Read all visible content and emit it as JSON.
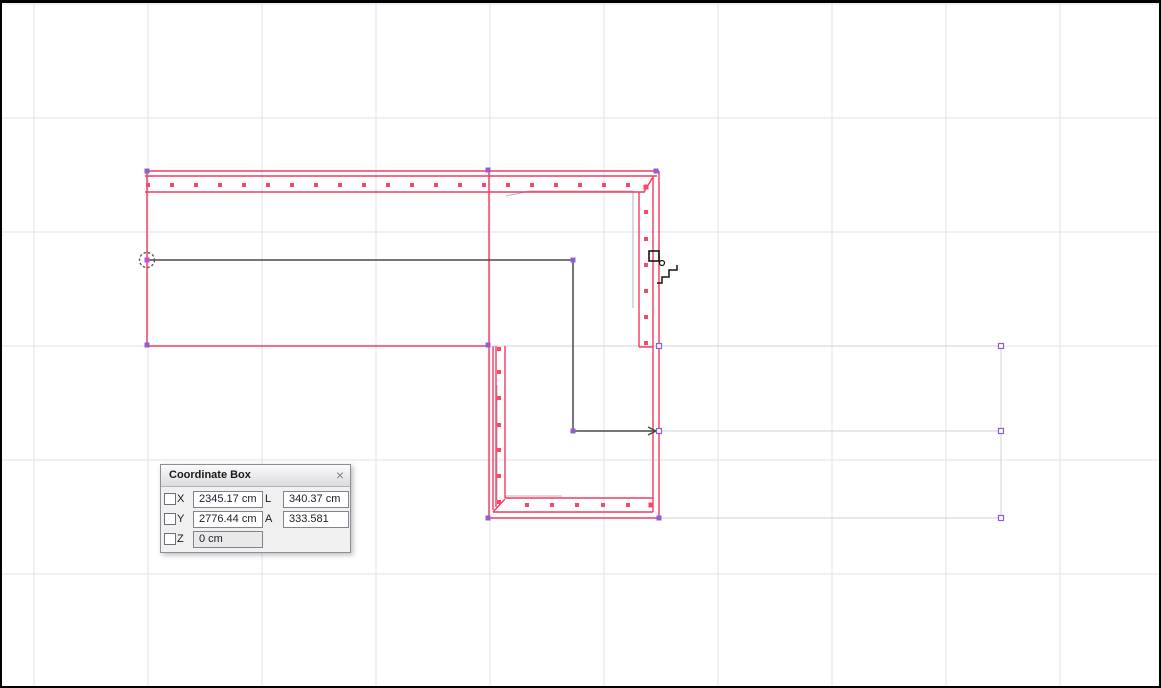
{
  "palette": {
    "title": "Coordinate Box",
    "close_glyph": "×",
    "rows": [
      {
        "axis": "X",
        "value": "2345.17 cm",
        "label2": "L",
        "value2": "340.37 cm"
      },
      {
        "axis": "Y",
        "value": "2776.44 cm",
        "label2": "A",
        "value2": "333.581"
      },
      {
        "axis": "Z",
        "value": "0 cm"
      }
    ]
  },
  "colors": {
    "grid": "#e2e2ee",
    "wall_red": "#f23b5f",
    "dot_red": "#f7486c",
    "black_line": "#4a4a4a",
    "ghost_gray": "#b9b9c2",
    "selection_gray": "#cfcfda",
    "handle_purple": "#8f5fd0",
    "origin_magenta": "#c44fd0",
    "cursor_black": "#151515"
  },
  "drawing": {
    "grid": {
      "xs": [
        34,
        148,
        262,
        376,
        490,
        604,
        718,
        832,
        946,
        1060
      ],
      "ys": [
        4,
        118,
        232,
        346,
        460,
        574,
        688
      ]
    },
    "gray_selection_lines": [
      [
        494,
        346,
        1001,
        346
      ],
      [
        661,
        431,
        1001,
        431
      ],
      [
        655,
        518,
        1001,
        518
      ],
      [
        1001,
        346,
        1001,
        518
      ]
    ],
    "ghost_lines": [
      [
        506,
        196,
        530,
        191
      ],
      [
        530,
        191,
        633,
        191
      ],
      [
        633,
        191,
        633,
        308
      ],
      [
        497,
        385,
        497,
        500
      ],
      [
        505,
        496,
        562,
        496
      ]
    ],
    "red_lines": [
      [
        145,
        171,
        659,
        171
      ],
      [
        145,
        176,
        657,
        176
      ],
      [
        145,
        192,
        645,
        192
      ],
      [
        644,
        192,
        653,
        177
      ],
      [
        147,
        171,
        147,
        346
      ],
      [
        147,
        346,
        489,
        346
      ],
      [
        489,
        171,
        489,
        518
      ],
      [
        659,
        171,
        659,
        518
      ],
      [
        489,
        518,
        659,
        518
      ],
      [
        653,
        176,
        653,
        512
      ],
      [
        639,
        192,
        639,
        347
      ],
      [
        639,
        347,
        653,
        347
      ],
      [
        493,
        346,
        493,
        510
      ],
      [
        496,
        346,
        496,
        507
      ],
      [
        505,
        346,
        505,
        498
      ],
      [
        505,
        498,
        653,
        498
      ],
      [
        493,
        512,
        653,
        512
      ],
      [
        493,
        512,
        505,
        499
      ]
    ],
    "wall_dots": [
      [
        148,
        185
      ],
      [
        172,
        185
      ],
      [
        196,
        185
      ],
      [
        220,
        185
      ],
      [
        244,
        185
      ],
      [
        268,
        185
      ],
      [
        292,
        185
      ],
      [
        316,
        185
      ],
      [
        340,
        185
      ],
      [
        364,
        185
      ],
      [
        388,
        185
      ],
      [
        412,
        185
      ],
      [
        436,
        185
      ],
      [
        460,
        185
      ],
      [
        484,
        185
      ],
      [
        508,
        185
      ],
      [
        532,
        185
      ],
      [
        556,
        185
      ],
      [
        580,
        185
      ],
      [
        604,
        185
      ],
      [
        628,
        185
      ],
      [
        646,
        212
      ],
      [
        646,
        239
      ],
      [
        646,
        265
      ],
      [
        646,
        291
      ],
      [
        646,
        317
      ],
      [
        646,
        343
      ],
      [
        499,
        349
      ],
      [
        499,
        372
      ],
      [
        499,
        398
      ],
      [
        499,
        425
      ],
      [
        499,
        450
      ],
      [
        499,
        476
      ],
      [
        499,
        502
      ],
      [
        527,
        505
      ],
      [
        552,
        505
      ],
      [
        577,
        505
      ],
      [
        603,
        505
      ],
      [
        628,
        505
      ]
    ],
    "corner_dots": [
      [
        646,
        187
      ],
      [
        651,
        505
      ]
    ],
    "black_polyline": [
      147,
      260,
      573,
      260,
      573,
      431,
      656,
      431
    ],
    "arrow_lines": [
      [
        648,
        427,
        656,
        431
      ],
      [
        648,
        435,
        656,
        431
      ]
    ],
    "origin": {
      "cx": 147,
      "cy": 260,
      "r": 7.5
    },
    "handles_solid": [
      [
        147,
        171
      ],
      [
        147,
        345
      ],
      [
        488,
        170
      ],
      [
        656,
        171
      ],
      [
        573,
        260
      ],
      [
        573,
        431
      ],
      [
        488,
        345
      ],
      [
        488,
        518
      ],
      [
        659,
        518
      ]
    ],
    "handles_outline": [
      [
        659,
        346
      ],
      [
        659,
        431
      ],
      [
        1001,
        346
      ],
      [
        1001,
        431
      ],
      [
        1001,
        518
      ]
    ],
    "cursor": {
      "square": [
        649,
        251,
        10,
        10
      ],
      "circle": [
        662,
        263,
        2.5
      ],
      "stairs": [
        657,
        283,
        662,
        283,
        662,
        277,
        669,
        277,
        669,
        270,
        677,
        270,
        677,
        265
      ]
    }
  }
}
